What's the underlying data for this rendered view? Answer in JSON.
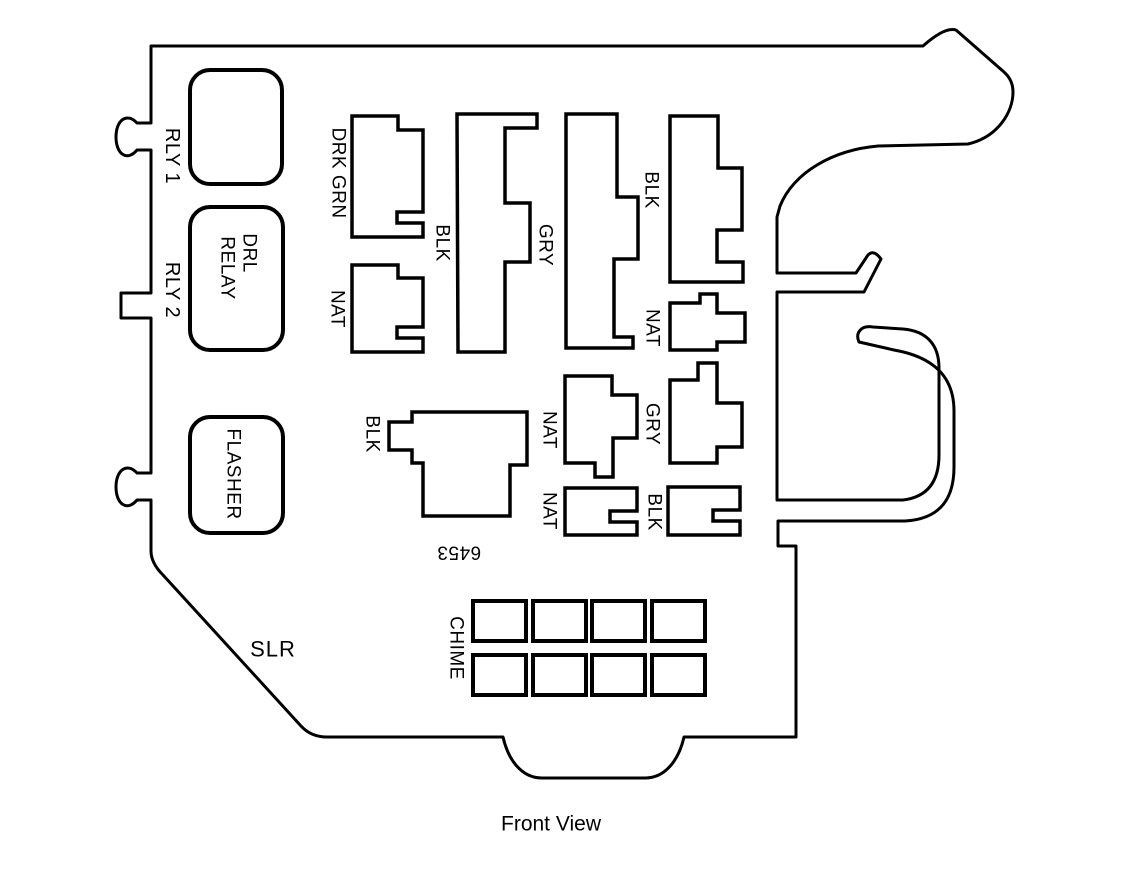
{
  "diagram": {
    "caption": "Front View",
    "connector_id": "6453",
    "sockets": {
      "rly1": "RLY 1",
      "rly2": "RLY 2",
      "drl_line1": "DRL",
      "drl_line2": "RELAY",
      "flasher": "FLASHER",
      "slr": "SLR",
      "chime": "CHIME"
    },
    "connectors": {
      "drk_grn": "DRK GRN",
      "nat_left": "NAT",
      "blk_tall": "BLK",
      "gry_tall": "GRY",
      "blk_right": "BLK",
      "nat_right": "NAT",
      "blk_main": "BLK",
      "nat_mid": "NAT",
      "gry_mid": "GRY",
      "nat_low": "NAT",
      "blk_low": "BLK"
    },
    "chime_grid": {
      "rows": 2,
      "cols": 4
    },
    "colors": {
      "line": "#000000",
      "background": "#ffffff"
    }
  }
}
